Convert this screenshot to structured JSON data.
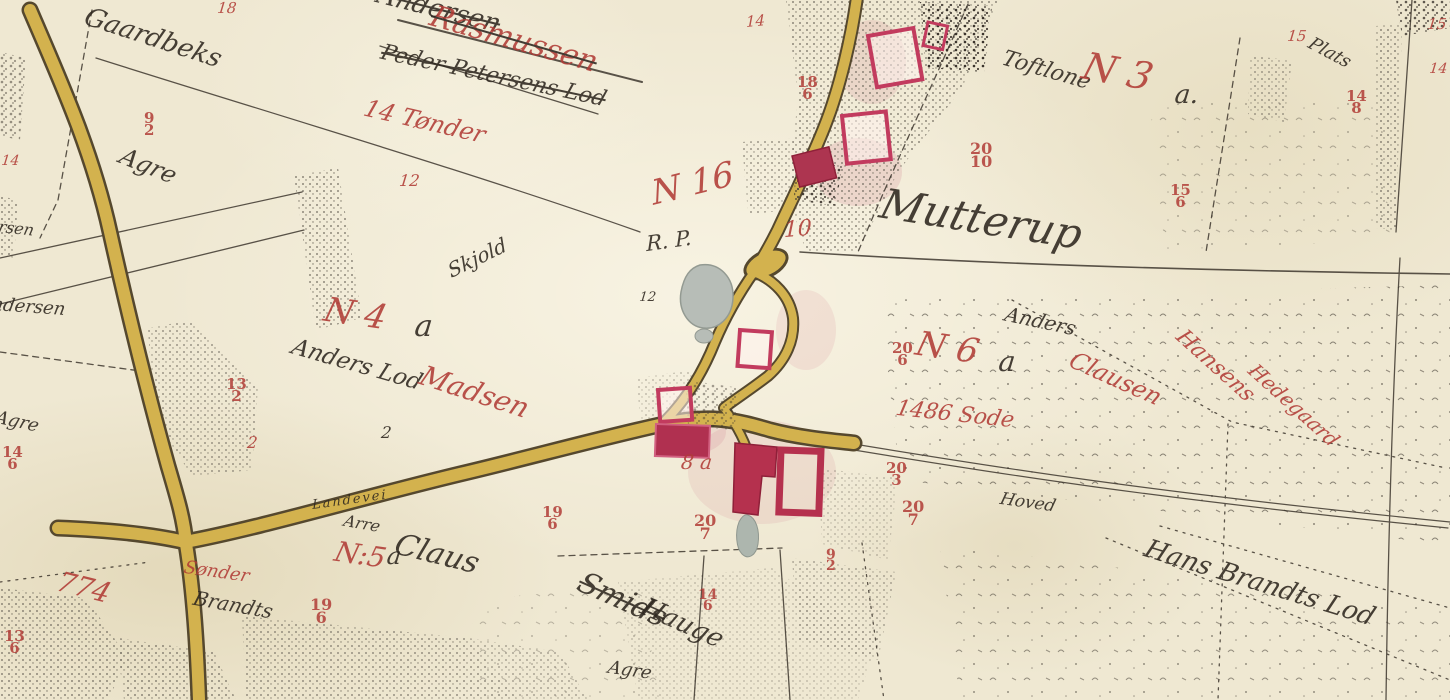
{
  "colors": {
    "paper": "#efe8d2",
    "road_yellow": "#d3b24e",
    "ink_black": "#2e271f",
    "ink_red": "#b13c36",
    "building_red": "#b5314e",
    "building_outline_red": "#c23b5e",
    "pond_grey": "#b7bdb7"
  },
  "labels": [
    {
      "text": "Gaardbeks"
    },
    {
      "text": "Agre"
    },
    {
      "text": "Andersen"
    },
    {
      "text": "Peder Petersens Lod"
    },
    {
      "text": "Rasmussen"
    },
    {
      "text": "14 Tønder"
    },
    {
      "text": "18"
    },
    {
      "text": "14"
    },
    {
      "text": "18\n6"
    },
    {
      "text": "20\n10"
    },
    {
      "text": "N 16"
    },
    {
      "text": "R. P."
    },
    {
      "text": "10"
    },
    {
      "text": "12"
    },
    {
      "text": "Mutterup"
    },
    {
      "text": "Toftlone"
    },
    {
      "text": "N 3"
    },
    {
      "text": "a."
    },
    {
      "text": "15\n6"
    },
    {
      "text": "15"
    },
    {
      "text": "14\n8"
    },
    {
      "text": "Plats"
    },
    {
      "text": "15"
    },
    {
      "text": "14"
    },
    {
      "text": "N 4"
    },
    {
      "text": "a"
    },
    {
      "text": "Skjold"
    },
    {
      "text": "Anders Lod"
    },
    {
      "text": "Madsen"
    },
    {
      "text": "9\n2"
    },
    {
      "text": "12"
    },
    {
      "text": "2"
    },
    {
      "text": "13\n2"
    },
    {
      "text": "2"
    },
    {
      "text": "14\n6"
    },
    {
      "text": "Agre"
    },
    {
      "text": "Andersen"
    },
    {
      "text": "rsen"
    },
    {
      "text": "14"
    },
    {
      "text": "13\n6"
    },
    {
      "text": "774"
    },
    {
      "text": "Sønder"
    },
    {
      "text": "Brandts"
    },
    {
      "text": "N:5"
    },
    {
      "text": "a"
    },
    {
      "text": "Claus"
    },
    {
      "text": "Arre"
    },
    {
      "text": "Landevei"
    },
    {
      "text": "19\n6"
    },
    {
      "text": "19\n6"
    },
    {
      "text": "20\n7"
    },
    {
      "text": "20\n7"
    },
    {
      "text": "8 a"
    },
    {
      "text": "Smids"
    },
    {
      "text": "Hauge"
    },
    {
      "text": "Agre"
    },
    {
      "text": "14\n6"
    },
    {
      "text": "N 6"
    },
    {
      "text": "a"
    },
    {
      "text": "20\n6"
    },
    {
      "text": "20\n3"
    },
    {
      "text": "1486 Sode"
    },
    {
      "text": "Anders"
    },
    {
      "text": "Clausen"
    },
    {
      "text": "Hansens"
    },
    {
      "text": "Hedegaard"
    },
    {
      "text": "Hoved"
    },
    {
      "text": "Hans Brandts Lod"
    },
    {
      "text": "9\n2"
    }
  ]
}
